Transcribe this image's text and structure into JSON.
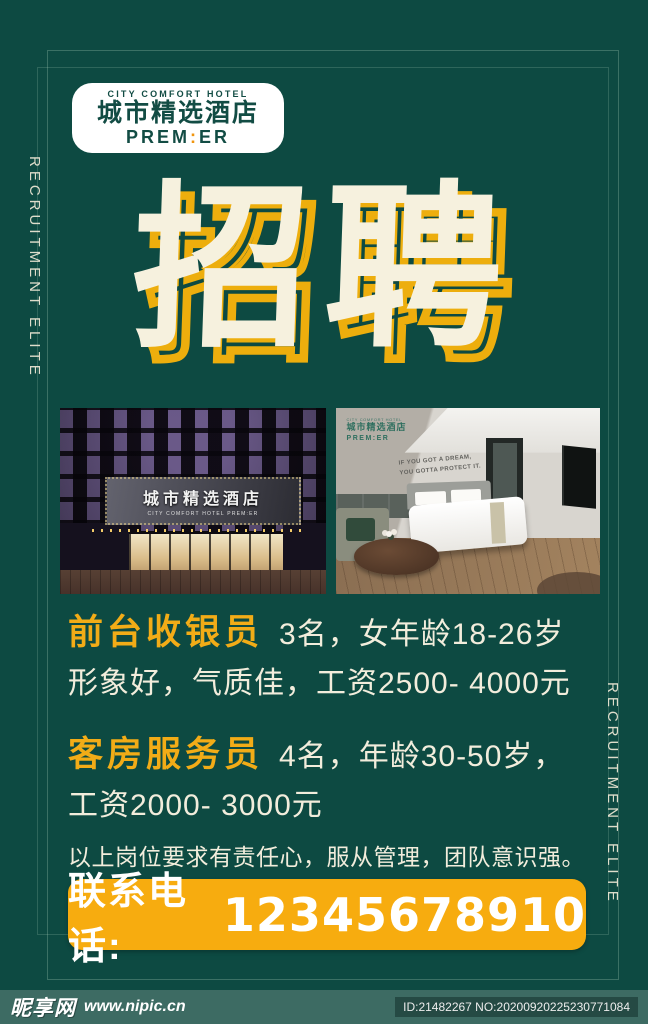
{
  "colors": {
    "background": "#0D4A42",
    "cream": "#F6F1DE",
    "accent_yellow": "#F7AC0F",
    "job_title_yellow": "#F2AC17",
    "logo_green": "#124C44",
    "footer_bar": "#3D6B63"
  },
  "side": {
    "left_text": "RECRUITMENT ELITE",
    "right_text": "RECRUITMENT ELITE"
  },
  "logo": {
    "tagline": "CITY COMFORT HOTEL",
    "name_cn": "城市精选酒店",
    "premier_pre": "PREM",
    "premier_colon": ":",
    "premier_post": "ER"
  },
  "headline": {
    "text": "招聘"
  },
  "photos": {
    "exterior": {
      "sign_cn": "城市精选酒店",
      "sign_en": "CITY COMFORT HOTEL PREM:ER"
    },
    "room": {
      "logo_tagline": "CITY COMFORT HOTEL",
      "logo_cn": "城市精选酒店",
      "logo_en": "PREM:ER",
      "quote_line1": "IF YOU GOT A DREAM,",
      "quote_line2": "YOU GOTTA PROTECT IT."
    }
  },
  "jobs": [
    {
      "title": "前台收银员",
      "detail": "3名，女年龄18-26岁",
      "detail2": "形象好，气质佳，工资2500- 4000元"
    },
    {
      "title": "客房服务员",
      "detail": "4名，年龄30-50岁，",
      "detail2": "工资2000- 3000元"
    }
  ],
  "note": "以上岗位要求有责任心，服从管理，团队意识强。",
  "contact": {
    "label": "联系电话:",
    "phone": "12345678910"
  },
  "footer": {
    "site_name": "昵享网",
    "site_url": "www.nipic.cn",
    "id_no": "ID:21482267 NO:20200920225230771084"
  }
}
